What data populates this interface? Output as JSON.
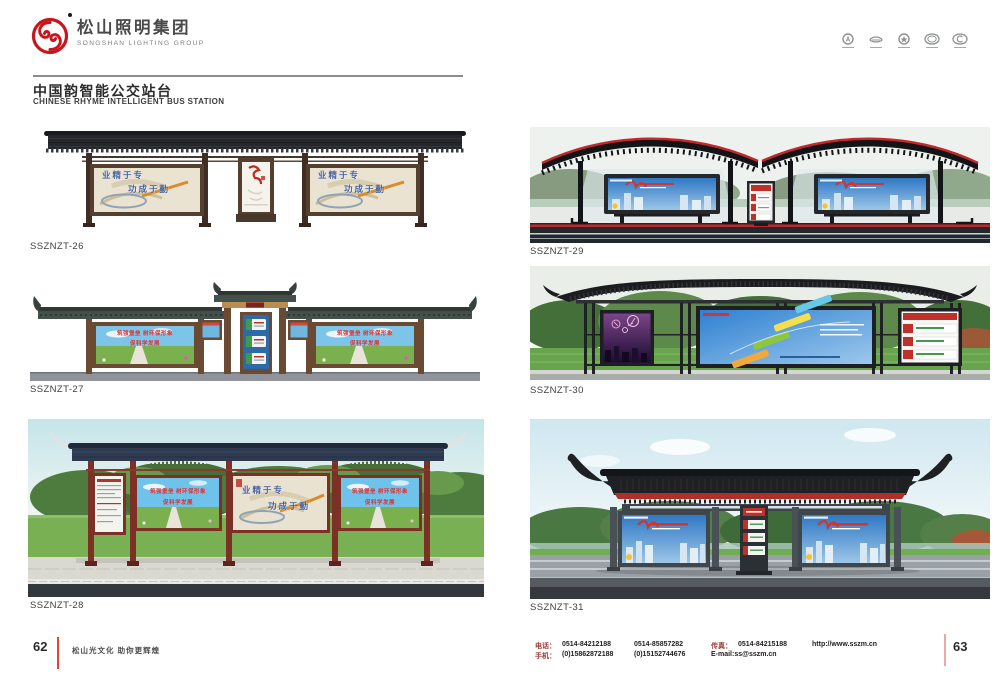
{
  "brand": {
    "name_cn": "松山照明集团",
    "name_en": "SONGSHAN LIGHTING GROUP",
    "brand_red": "#c8161d"
  },
  "header_icons": [
    "cert-badge-1",
    "cert-badge-2",
    "cert-badge-3",
    "cert-badge-4",
    "cert-badge-5"
  ],
  "page_header": {
    "title_cn": "中国韵智能公交站台",
    "title_en": "CHINESE RHYME INTELLIGENT BUS STATION"
  },
  "products": [
    {
      "code": "SSZNZT-26",
      "slogan_line1": "业精于专",
      "slogan_line2": "功成于勤"
    },
    {
      "code": "SSZNZT-27",
      "slogan_line1": "筑强堡垒 树环保形象",
      "slogan_line2": "促科学发展"
    },
    {
      "code": "SSZNZT-28",
      "slogan_line1": "筑强堡垒 树环保形象",
      "slogan_line2": "促科学发展",
      "center_slogan_line1": "业精于专",
      "center_slogan_line2": "功成于勤"
    },
    {
      "code": "SSZNZT-29"
    },
    {
      "code": "SSZNZT-30"
    },
    {
      "code": "SSZNZT-31"
    }
  ],
  "footer": {
    "page_left": "62",
    "page_right": "63",
    "tagline": "松山光文化  助你更辉煌",
    "phone_label": "电话：",
    "phone_1": "0514-84212188",
    "phone_2": "0514-85857282",
    "mobile_label": "手机：",
    "mobile_1": "(0)15862872188",
    "mobile_2": "(0)15152744676",
    "fax_label": "传真：",
    "fax": "0514-84215188",
    "email": "E-mail:ss@sszm.cn",
    "website": "http://www.sszm.cn"
  },
  "colors": {
    "brand_red": "#c8161d",
    "footer_line_red": "#e8433a",
    "roof_dark": "#26272c",
    "wood_brown": "#55402f",
    "maroon_post": "#7c3026"
  }
}
